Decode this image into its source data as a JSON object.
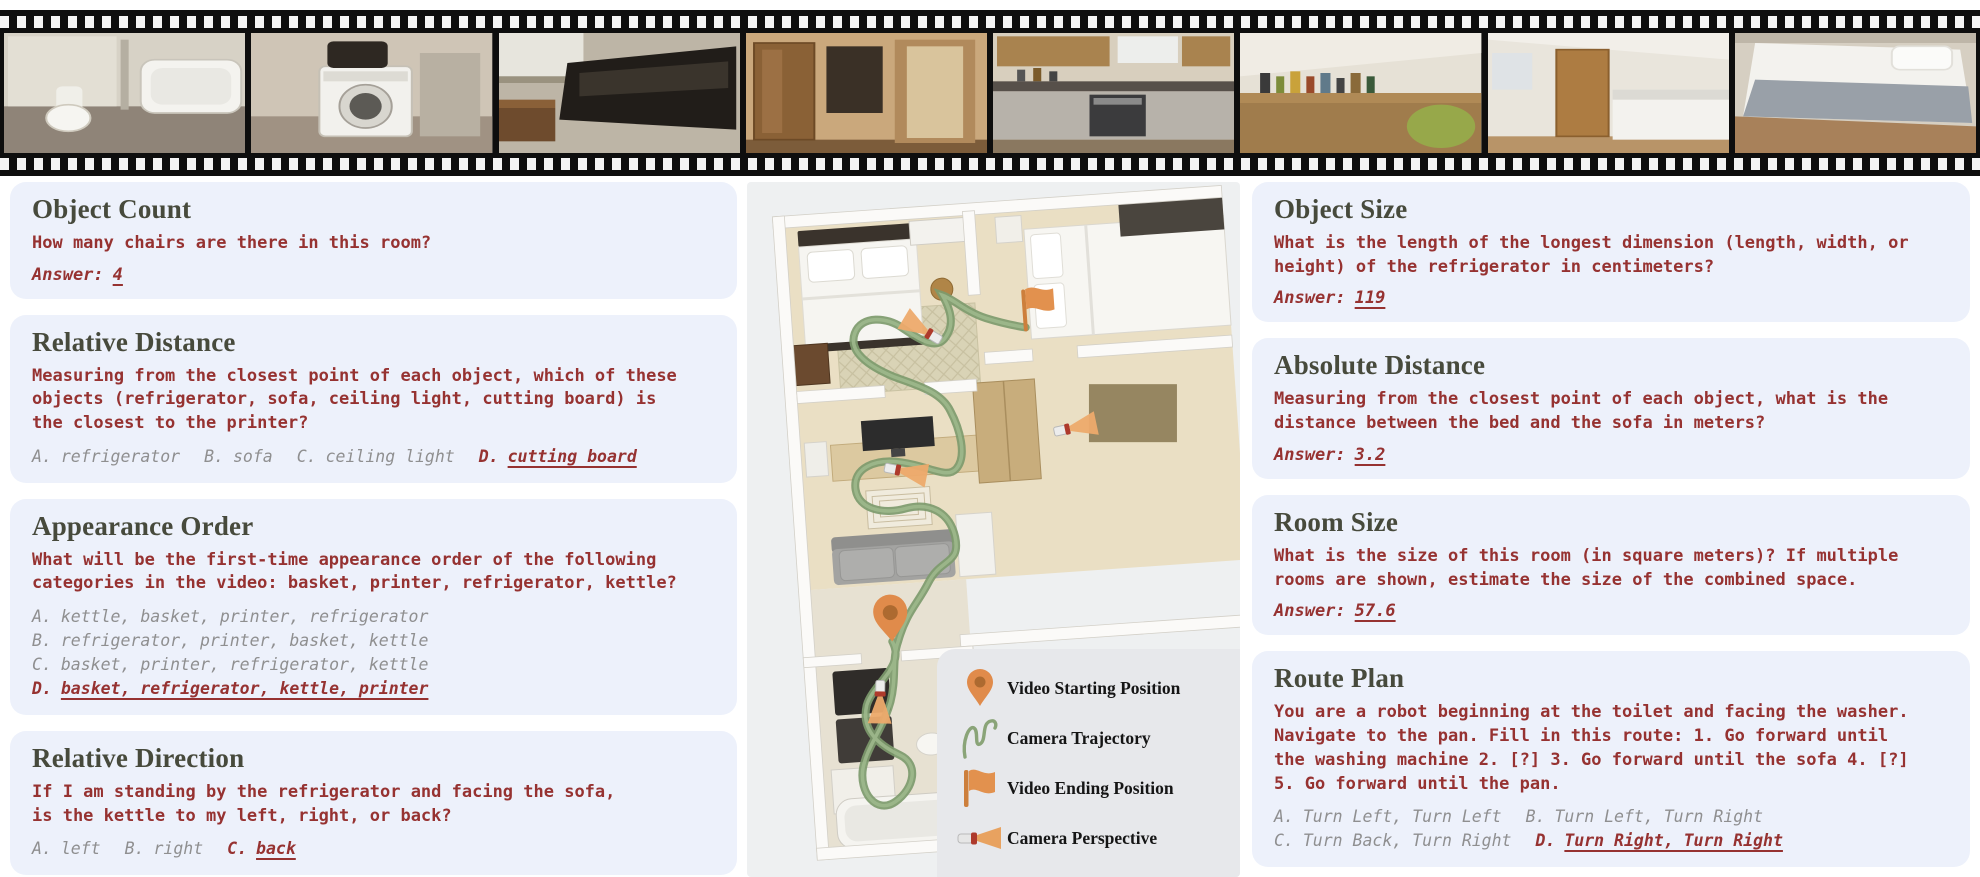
{
  "figure": {
    "name": "spatial-video-qa-benchmark-figure"
  },
  "film_strip": {
    "frames": [
      {
        "name": "bathroom"
      },
      {
        "name": "washing-machine"
      },
      {
        "name": "living-room-sofa"
      },
      {
        "name": "hallway-wardrobe"
      },
      {
        "name": "kitchen"
      },
      {
        "name": "desk-with-bottles"
      },
      {
        "name": "bedroom-cabinet"
      },
      {
        "name": "bedroom-bed"
      }
    ]
  },
  "left_cards": [
    {
      "id": "object-count",
      "title": "Object Count",
      "question_lines": [
        "How many chairs are there in this room?"
      ],
      "answer_label": "Answer:",
      "answer": "4"
    },
    {
      "id": "relative-distance",
      "title": "Relative Distance",
      "question_lines": [
        "Measuring from the closest point of each object, which of these",
        "objects (refrigerator, sofa, ceiling light, cutting board) is",
        "the closest to the printer?"
      ],
      "option_rows": [
        [
          {
            "label": "A.",
            "text": "refrigerator",
            "correct": false
          },
          {
            "label": "B.",
            "text": "sofa",
            "correct": false
          },
          {
            "label": "C.",
            "text": "ceiling light",
            "correct": false
          },
          {
            "label": "D.",
            "text": "cutting board",
            "correct": true
          }
        ]
      ]
    },
    {
      "id": "appearance-order",
      "title": "Appearance Order",
      "question_lines": [
        "What will be the first-time appearance order of the following",
        "categories in the video: basket, printer, refrigerator, kettle?"
      ],
      "option_rows": [
        [
          {
            "label": "A.",
            "text": "kettle, basket, printer, refrigerator",
            "correct": false
          }
        ],
        [
          {
            "label": "B.",
            "text": "refrigerator, printer, basket, kettle",
            "correct": false
          }
        ],
        [
          {
            "label": "C.",
            "text": "basket, printer, refrigerator, kettle",
            "correct": false
          }
        ],
        [
          {
            "label": "D.",
            "text": "basket, refrigerator, kettle, printer",
            "correct": true
          }
        ]
      ]
    },
    {
      "id": "relative-direction",
      "title": "Relative Direction",
      "question_lines": [
        "If I am standing by the refrigerator and facing the sofa,",
        "is the kettle to my left, right, or back?"
      ],
      "option_rows": [
        [
          {
            "label": "A.",
            "text": "left",
            "correct": false
          },
          {
            "label": "B.",
            "text": "right",
            "correct": false
          },
          {
            "label": "C.",
            "text": "back",
            "correct": true
          }
        ]
      ]
    }
  ],
  "right_cards": [
    {
      "id": "object-size",
      "title": "Object Size",
      "question_lines": [
        "What is the length of the longest dimension (length, width, or",
        "height) of the refrigerator in centimeters?"
      ],
      "answer_label": "Answer:",
      "answer": "119"
    },
    {
      "id": "absolute-distance",
      "title": "Absolute Distance",
      "question_lines": [
        "Measuring from the closest point of each object, what is the",
        "distance between the bed and the sofa in meters?"
      ],
      "answer_label": "Answer:",
      "answer": "3.2"
    },
    {
      "id": "room-size",
      "title": "Room Size",
      "question_lines": [
        "What is the size of this room (in square meters)? If multiple",
        "rooms are shown, estimate the size of the combined space."
      ],
      "answer_label": "Answer:",
      "answer": "57.6"
    },
    {
      "id": "route-plan",
      "title": "Route Plan",
      "question_lines": [
        "You are a robot beginning at the toilet and facing the washer.",
        "Navigate to the pan. Fill in this route: 1. Go forward until",
        "the washing machine 2. [?] 3. Go forward until the sofa 4. [?]",
        "5. Go forward until the pan."
      ],
      "option_rows": [
        [
          {
            "label": "A.",
            "text": "Turn Left, Turn Left",
            "correct": false
          },
          {
            "label": "B.",
            "text": "Turn Left, Turn Right",
            "correct": false
          }
        ],
        [
          {
            "label": "C.",
            "text": "Turn Back, Turn Right",
            "correct": false
          },
          {
            "label": "D.",
            "text": "Turn Right, Turn Right",
            "correct": true
          }
        ]
      ]
    }
  ],
  "floorplan": {
    "legend": {
      "items": [
        {
          "icon": "start-pin-icon",
          "label": "Video Starting Position"
        },
        {
          "icon": "trajectory-icon",
          "label": "Camera Trajectory"
        },
        {
          "icon": "end-flag-icon",
          "label": "Video Ending Position"
        },
        {
          "icon": "camera-perspective-icon",
          "label": "Camera Perspective"
        }
      ]
    }
  },
  "colors": {
    "card_bg": "#edf1fb",
    "title": "#474a3c",
    "question_red": "#963231",
    "option_gray": "#8f8f90",
    "accent_orange": "#e08d4c",
    "trajectory_green": "#7f9c6e",
    "panel_bg": "#eef0f1"
  }
}
